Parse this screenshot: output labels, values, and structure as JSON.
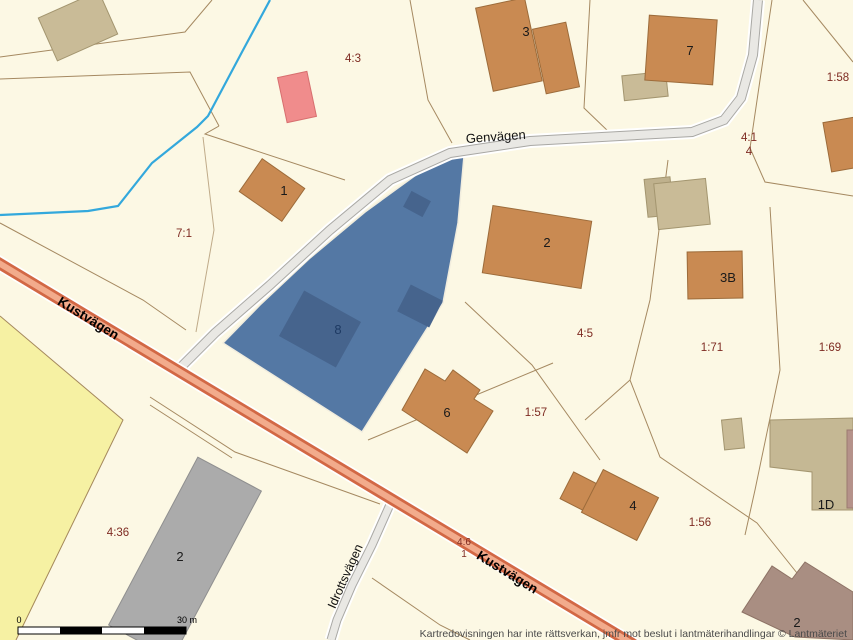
{
  "map": {
    "attribution": "Kartredovisningen har inte rättsverkan, jmfr mot beslut i lantmäterihandlingar © Lantmäteriet",
    "scale_bar": {
      "min": "0",
      "max": "30 m"
    },
    "roads": {
      "genvagen": "Genvägen",
      "kustvagen": "Kustvägen",
      "idrottsvagen": "Idrottsvägen"
    },
    "highlight": {
      "parcel_building": "8"
    },
    "parcels": {
      "p4_3": "4:3",
      "p7_1": "7:1",
      "p1_58": "1:58",
      "p4_1": "4:1",
      "p4": "4",
      "p4_5": "4:5",
      "p1_71": "1:71",
      "p1_69": "1:69",
      "p1_57": "1:57",
      "p1_56": "1:56",
      "p4_36": "4:36",
      "p4_6": "4:6",
      "p4_6b": "1"
    },
    "buildings": {
      "b1": "1",
      "b3": "3",
      "b7": "7",
      "b2_center": "2",
      "b3b": "3B",
      "b6": "6",
      "b4": "4",
      "b1d": "1D",
      "b2_se": "2",
      "b2_gray": "2"
    },
    "colors": {
      "background": "#FCF8E4",
      "highlight_fill": "#5478A4",
      "highlight_building": "#46648D",
      "building_fill": "#C98A52",
      "outbuilding_fill": "#C9BB97",
      "major_road": "#D26845",
      "minor_road": "#E7E6E2",
      "water": "#33A8DC",
      "parcel_label": "#7E2B22",
      "field_yellow": "#F6F1A3"
    }
  }
}
